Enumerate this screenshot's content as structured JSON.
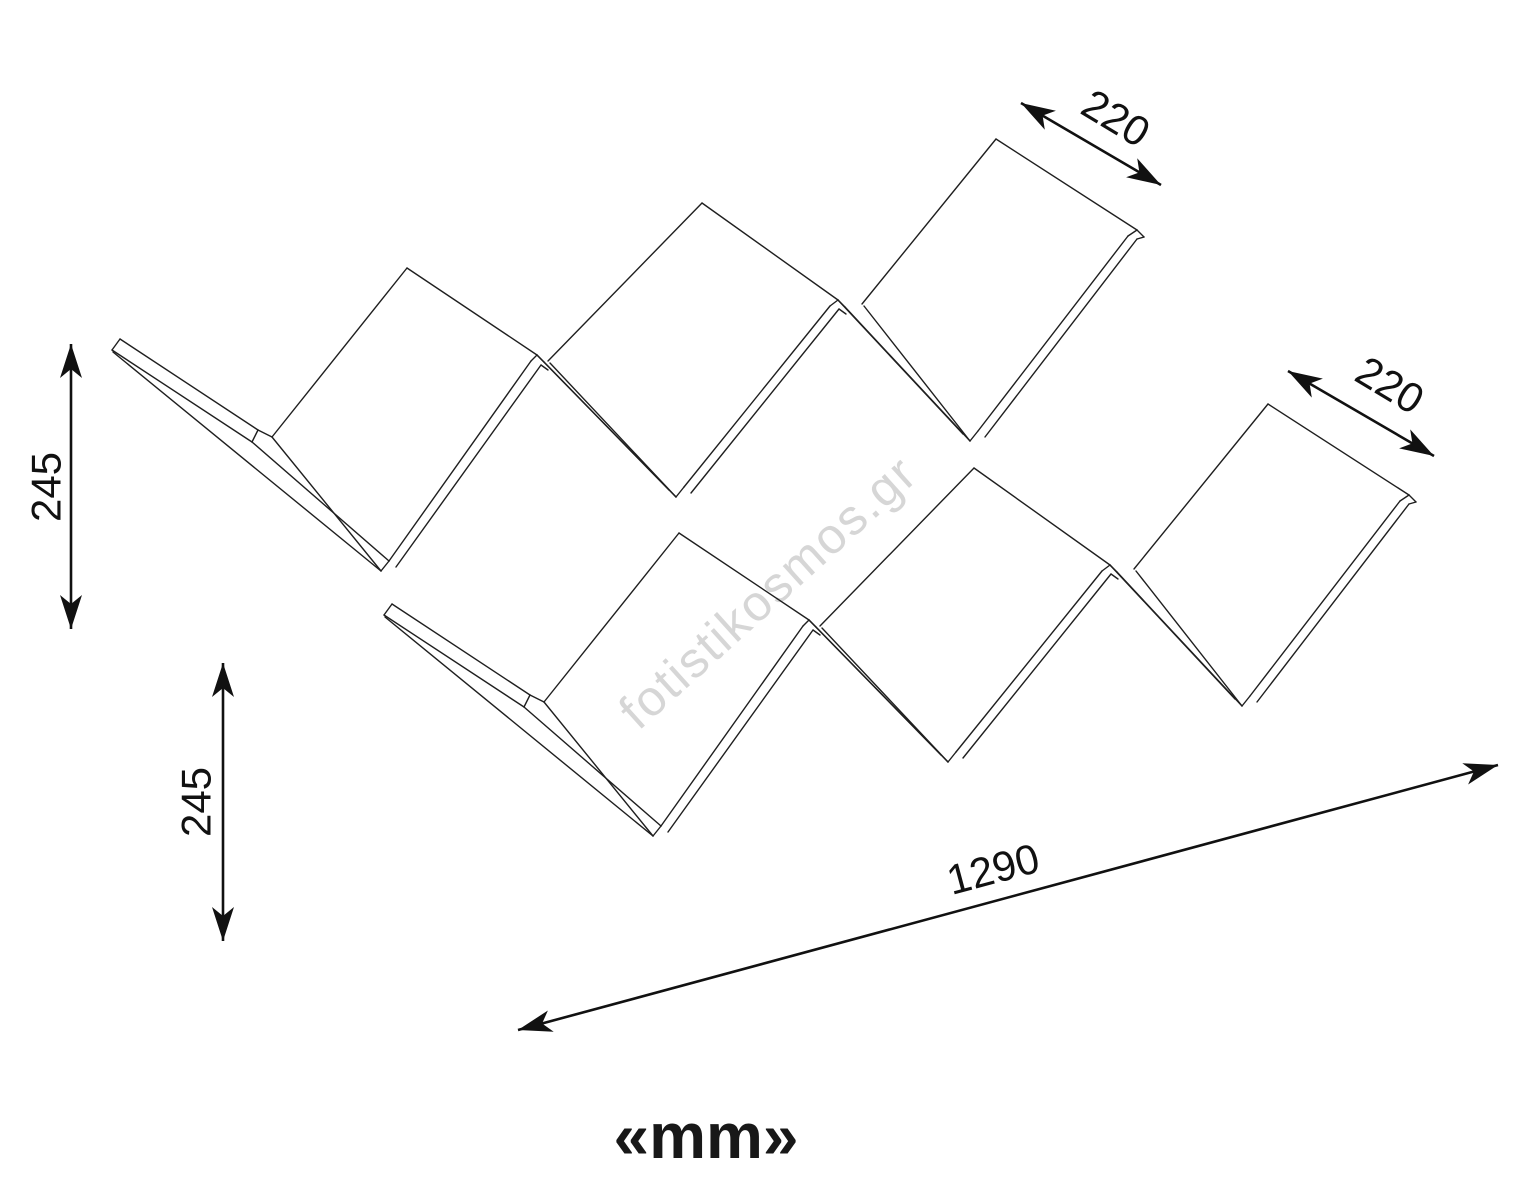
{
  "drawing": {
    "unit_label": "«mm»",
    "watermark": "fotistikosmos.gr",
    "dimensions": {
      "depth_top": {
        "value": "220"
      },
      "depth_right": {
        "value": "220"
      },
      "height_upper": {
        "value": "245"
      },
      "height_lower": {
        "value": "245"
      },
      "width_total": {
        "value": "1290"
      }
    },
    "colors": {
      "line": "#1f1f1f",
      "dimension": "#111111",
      "watermark": "#c7c7c7",
      "background": "#ffffff"
    }
  }
}
